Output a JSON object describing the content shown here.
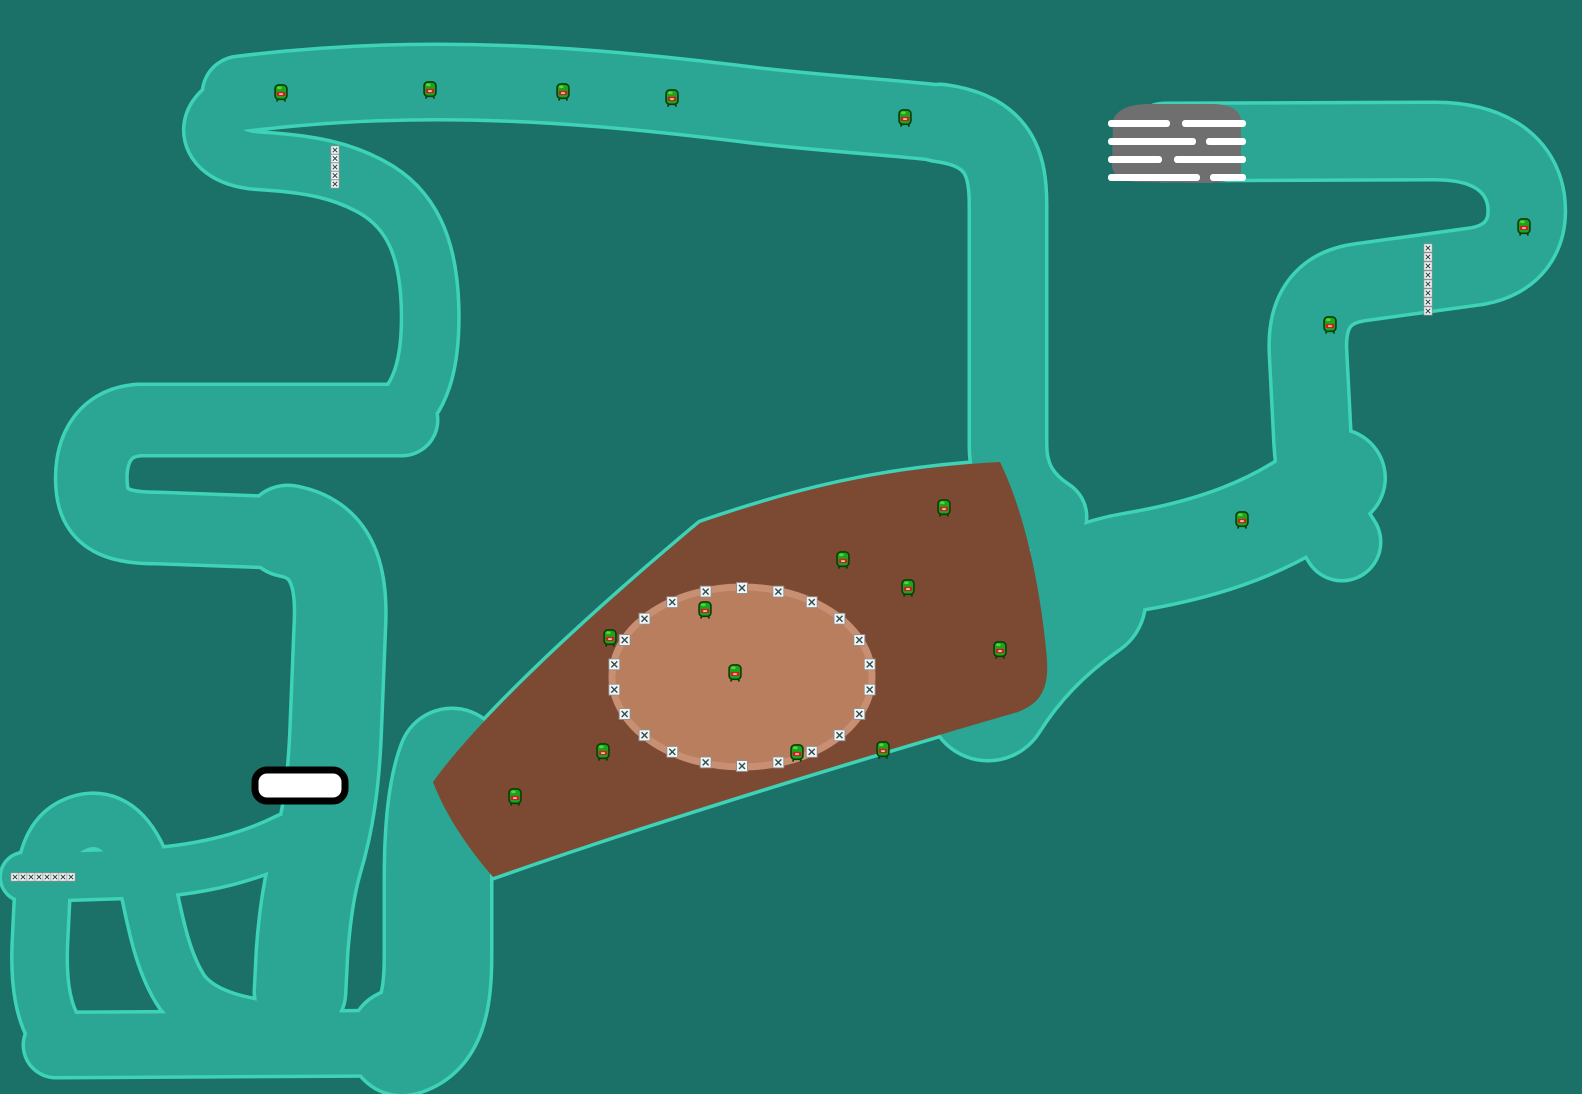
{
  "scene": {
    "kind": "kart-racing-track-map",
    "width": 1582,
    "height": 1094
  },
  "colors": {
    "background": "#1b7068",
    "track_fill": "#2ba694",
    "track_outline": "#3ed2b7",
    "outline_extra": 7,
    "dirt": "#7c4a33",
    "oval_fill": "#b97e5e",
    "oval_ring": "#c98f72",
    "grid_pad": "#6f6f6f",
    "grid_stripe": "#ffffff",
    "tunnel_fill": "#ffffff",
    "tunnel_border": "#000000",
    "box_bg": "#f4f4f4",
    "box_border": "#8f8f8f",
    "box_glyph": "#2f4f4f",
    "creature_body": "#1ca51c",
    "creature_dark": "#0a3c0a",
    "creature_shine": "#5ede3a",
    "creature_mouth": "#cf1f1f",
    "creature_tooth": "#ffffff"
  },
  "track": {
    "segments": [
      {
        "name": "top-straight",
        "d": "M 240,94 C 430,70 600,86 760,106 C 850,116 905,118 948,124",
        "w": 72
      },
      {
        "name": "north-descent",
        "d": "M 940,123 C 1000,131 1008,165 1008,205 L 1008,445 C 1008,478 1022,500 1048,517",
        "w": 74
      },
      {
        "name": "hairpin-return",
        "d": "M 268,96 C 198,98 192,158 262,161 C 312,164 342,171 370,186 C 412,208 428,248 430,305 C 432,365 420,400 394,419",
        "w": 54
      },
      {
        "name": "west-band-upper",
        "d": "M 402,420 L 140,420 C 100,422 88,456 92,490 C 96,522 122,528 158,528 L 296,533",
        "w": 68
      },
      {
        "name": "tunnel-band",
        "d": "M 288,531 C 330,539 342,572 340,622 L 336,722 C 334,782 328,822 316,862 C 308,890 304,925 302,952 L 300,992",
        "w": 88
      },
      {
        "name": "item-stub",
        "d": "M 25,877 L 150,873 C 210,868 252,856 288,838",
        "w": 46
      },
      {
        "name": "serpentine-left",
        "d": "M 62,1040 C 42,1018 38,980 40,940 L 42,900 C 44,858 52,830 84,822 C 120,814 140,852 148,888 C 155,920 162,962 182,992 C 202,1018 242,1028 302,1032",
        "w": 52
      },
      {
        "name": "south-band",
        "d": "M 56,1045 L 420,1043",
        "w": 62
      },
      {
        "name": "east-riser",
        "d": "M 402,1042 C 432,1034 438,1000 438,955 L 438,880 C 438,828 442,788 452,762",
        "w": 104
      },
      {
        "name": "grid-straight-hairpin",
        "d": "M 1165,142 L 1430,141 C 1484,140 1520,160 1526,200 C 1531,238 1510,260 1478,266 L 1362,282 C 1322,287 1306,312 1308,352 L 1312,430 C 1314,482 1322,512 1342,542",
        "w": 74
      },
      {
        "name": "junction-band-upper",
        "d": "M 1336,478 C 1276,528 1204,550 1132,562 C 1072,572 1032,602 1002,642",
        "w": 95
      },
      {
        "name": "junction-band-lower",
        "d": "M 1085,600 C 1042,630 1012,662 988,700",
        "w": 118
      }
    ]
  },
  "dirt": {
    "path": "M 433,782 C 470,730 560,640 700,523 C 790,492 880,468 1000,462 C 1028,520 1042,600 1047,660 C 1049,692 1038,704 1018,712 C 880,752 660,818 493,877 C 468,848 446,816 433,782 Z",
    "oval": {
      "cx": 742,
      "cy": 677,
      "rx": 130,
      "ry": 90,
      "ring_width": 7
    }
  },
  "start_grid": {
    "pad_path": "M 1113,120 C 1118,108 1132,104 1150,104 L 1212,104 C 1230,104 1240,110 1241,120 L 1241,172 C 1238,180 1224,183 1205,183 L 1140,182 C 1122,182 1113,176 1112,166 Z",
    "stripe_h": 7,
    "stripes": [
      {
        "y": 120,
        "runs": [
          [
            1108,
            62
          ],
          [
            1182,
            64
          ]
        ]
      },
      {
        "y": 138,
        "runs": [
          [
            1108,
            88
          ],
          [
            1206,
            40
          ]
        ]
      },
      {
        "y": 156,
        "runs": [
          [
            1108,
            54
          ],
          [
            1174,
            72
          ]
        ]
      },
      {
        "y": 174,
        "runs": [
          [
            1108,
            92
          ],
          [
            1210,
            36
          ]
        ]
      }
    ]
  },
  "tunnel": {
    "x": 255,
    "y": 770,
    "w": 90,
    "h": 31,
    "r": 12,
    "border": 7
  },
  "item_boxes": {
    "strip_size": 9,
    "ring_size": 12,
    "strips": [
      {
        "orient": "v",
        "x": 335,
        "y0": 150,
        "step": 8.5,
        "count": 5
      },
      {
        "orient": "v",
        "x": 1428,
        "y0": 248,
        "step": 9,
        "count": 8
      },
      {
        "orient": "h",
        "y": 877,
        "x0": 15,
        "step": 8,
        "count": 8
      }
    ],
    "ellipse_ring": {
      "cx": 742,
      "cy": 677,
      "rx": 129,
      "ry": 89,
      "count": 22
    }
  },
  "creatures": {
    "size": [
      15,
      18
    ],
    "positions": [
      [
        281,
        93
      ],
      [
        430,
        90
      ],
      [
        563,
        92
      ],
      [
        672,
        98
      ],
      [
        905,
        118
      ],
      [
        1524,
        227
      ],
      [
        1330,
        325
      ],
      [
        1242,
        520
      ],
      [
        944,
        508
      ],
      [
        843,
        560
      ],
      [
        908,
        588
      ],
      [
        1000,
        650
      ],
      [
        610,
        638
      ],
      [
        705,
        610
      ],
      [
        735,
        673
      ],
      [
        603,
        752
      ],
      [
        797,
        753
      ],
      [
        883,
        750
      ],
      [
        515,
        797
      ]
    ]
  }
}
